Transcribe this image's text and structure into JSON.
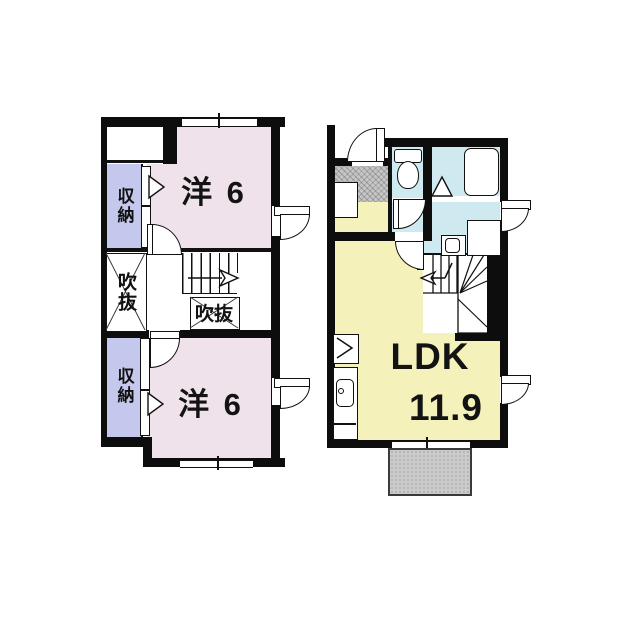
{
  "floor_plan": {
    "second_floor": {
      "room_top_label": "洋 6",
      "room_bottom_label": "洋 6",
      "closet_top_label": "収納",
      "closet_bottom_label": "収納",
      "void_left_label": "吹抜",
      "void_center_label": "吹抜"
    },
    "first_floor": {
      "ldk_label": "LDK",
      "ldk_area": "11.9"
    },
    "colors": {
      "room_pink": "#f0e2ea",
      "closet_purple": "#c5c8ed",
      "ldk_yellow": "#f5f1bb",
      "wet_area_blue": "#cfe9f1",
      "entrance_gray": "#c6c6c6",
      "terrace_gray": "#cbcbcb",
      "wall_black": "#0d0d0d",
      "background": "#ffffff"
    }
  }
}
